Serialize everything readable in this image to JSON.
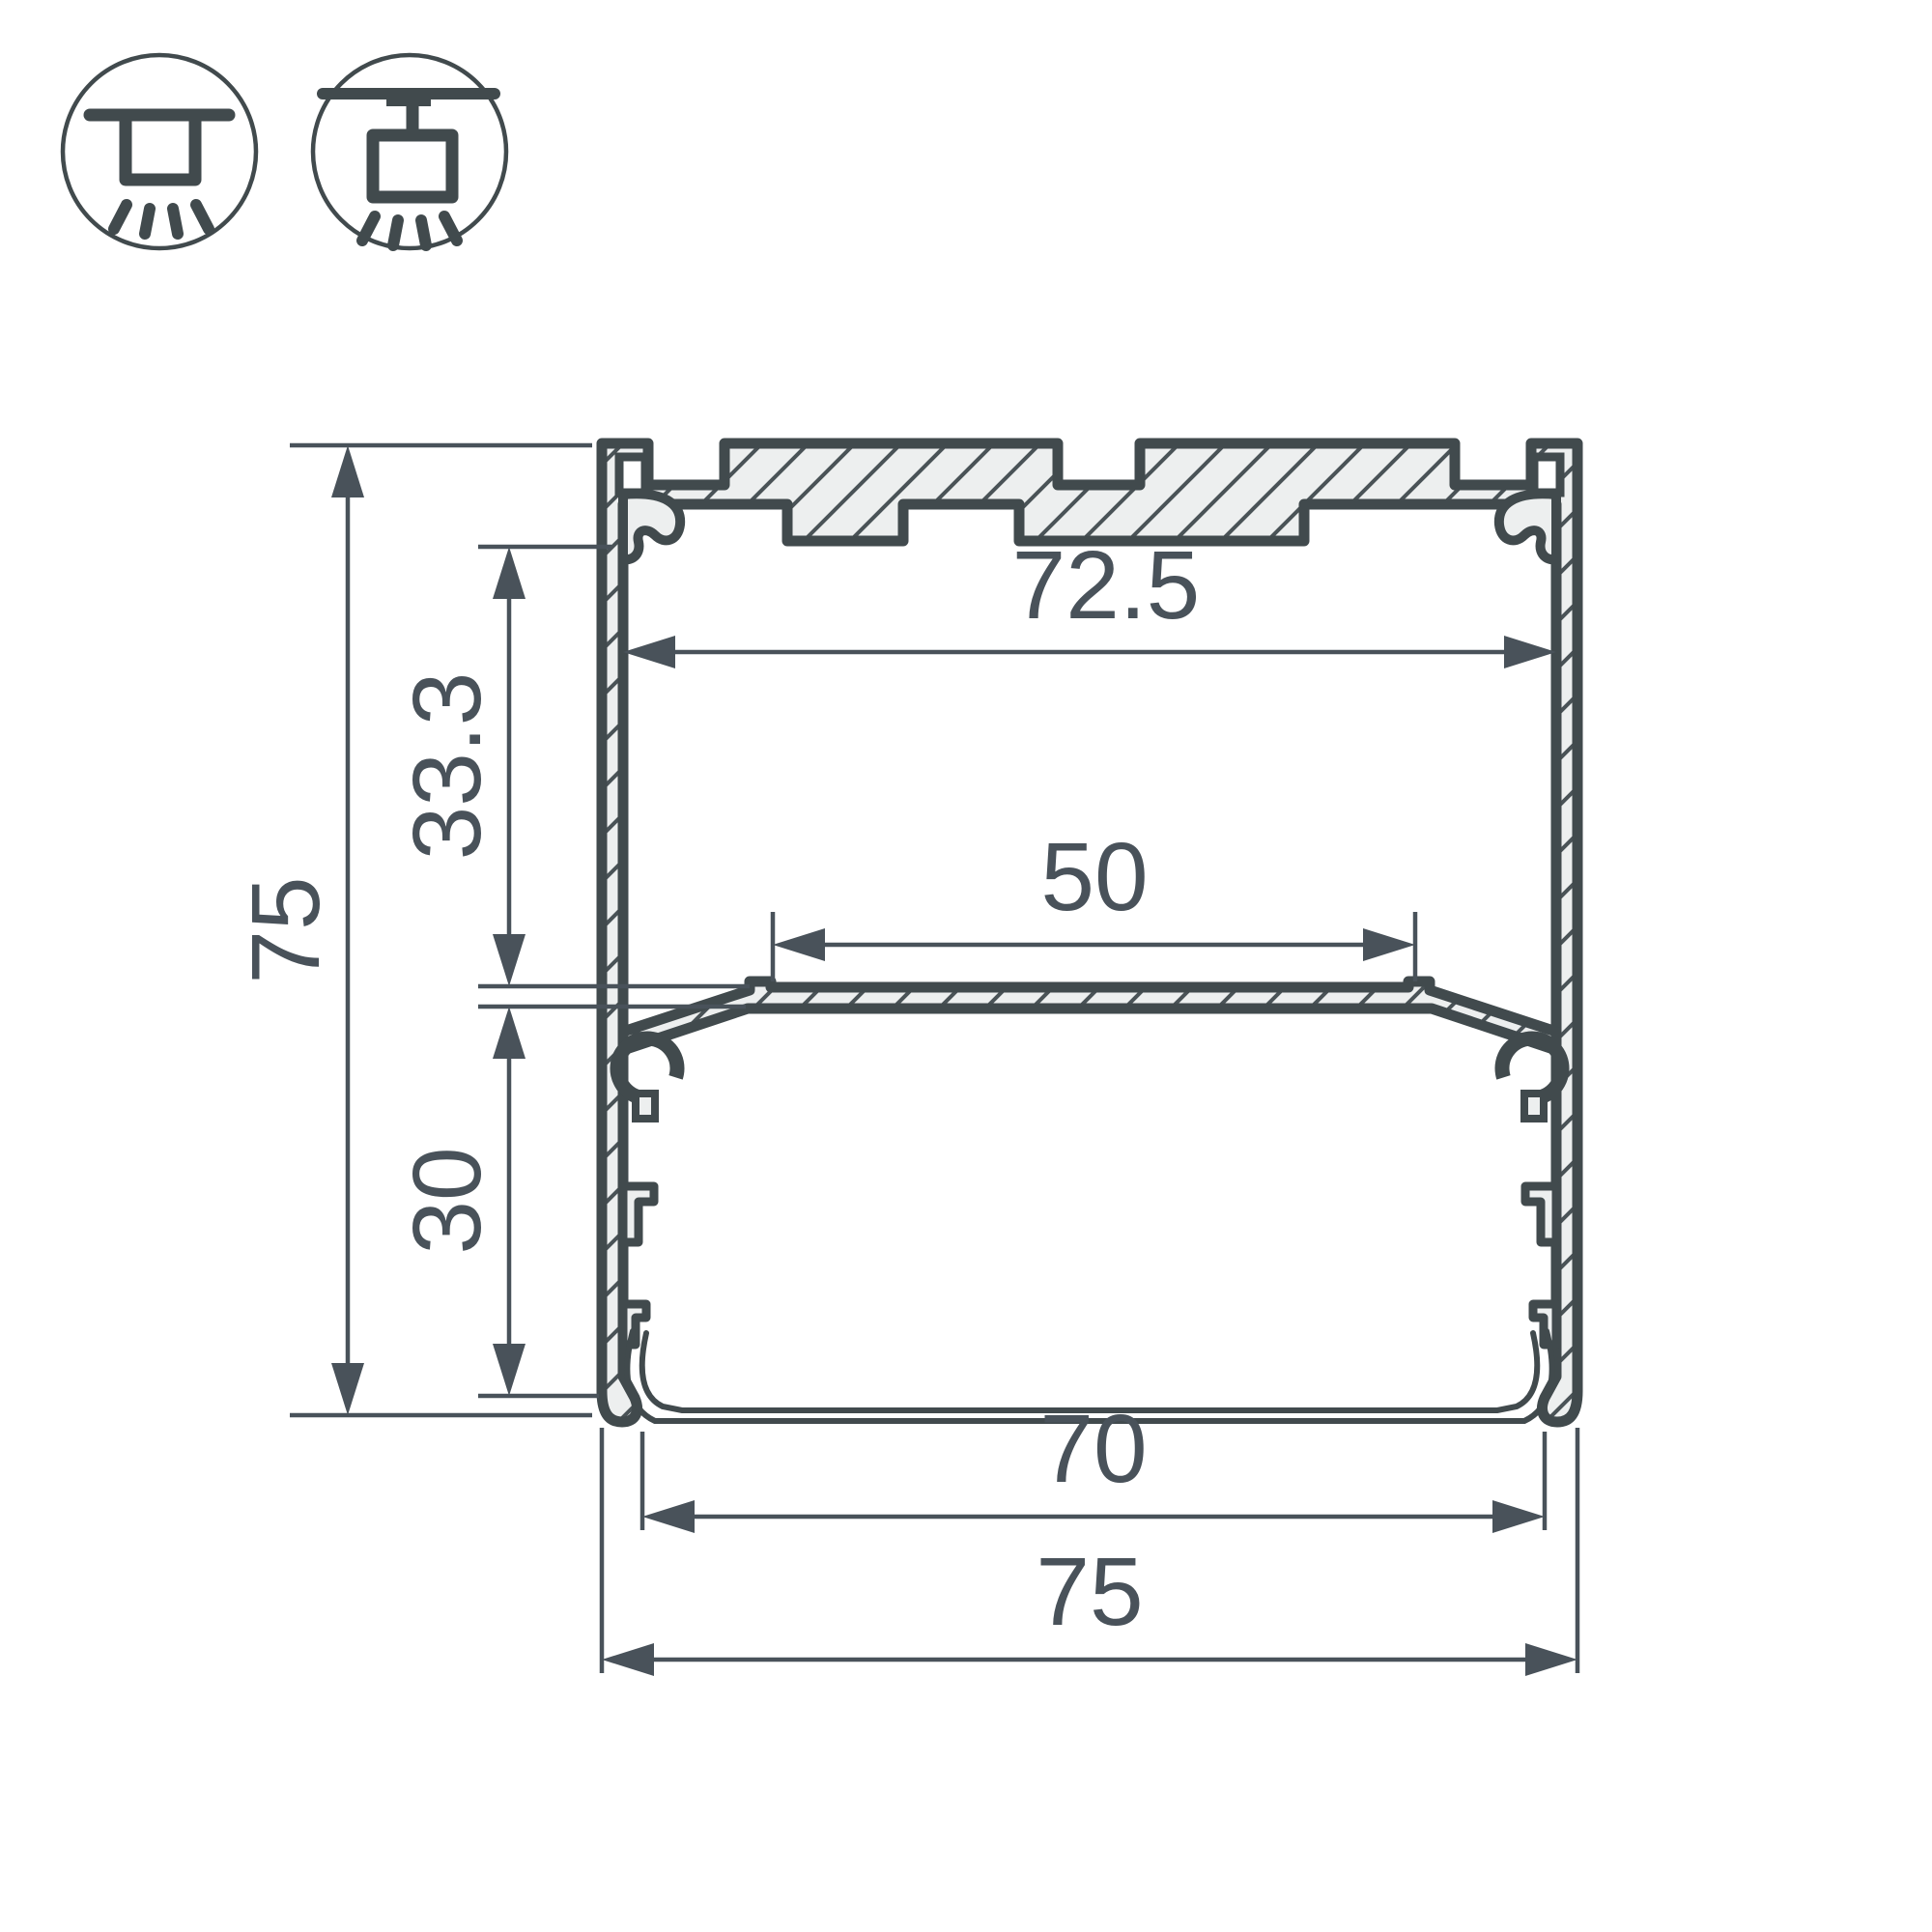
{
  "drawing": {
    "type": "profile-cross-section-technical-drawing",
    "colors": {
      "line": "#414a4d",
      "material_fill": "#edefef",
      "dimension_text": "#49525a",
      "background": "#ffffff"
    },
    "icons": [
      {
        "name": "surface-ceiling-mount-icon",
        "label": "surface mount"
      },
      {
        "name": "pendant-suspended-mount-icon",
        "label": "suspended mount"
      }
    ],
    "dimensions": {
      "total_height": "75",
      "top_to_led_plate": "33.3",
      "led_plate_to_bottom": "30",
      "inner_width": "72.5",
      "led_plate_width": "50",
      "diffuser_width": "70",
      "total_width": "75"
    }
  }
}
